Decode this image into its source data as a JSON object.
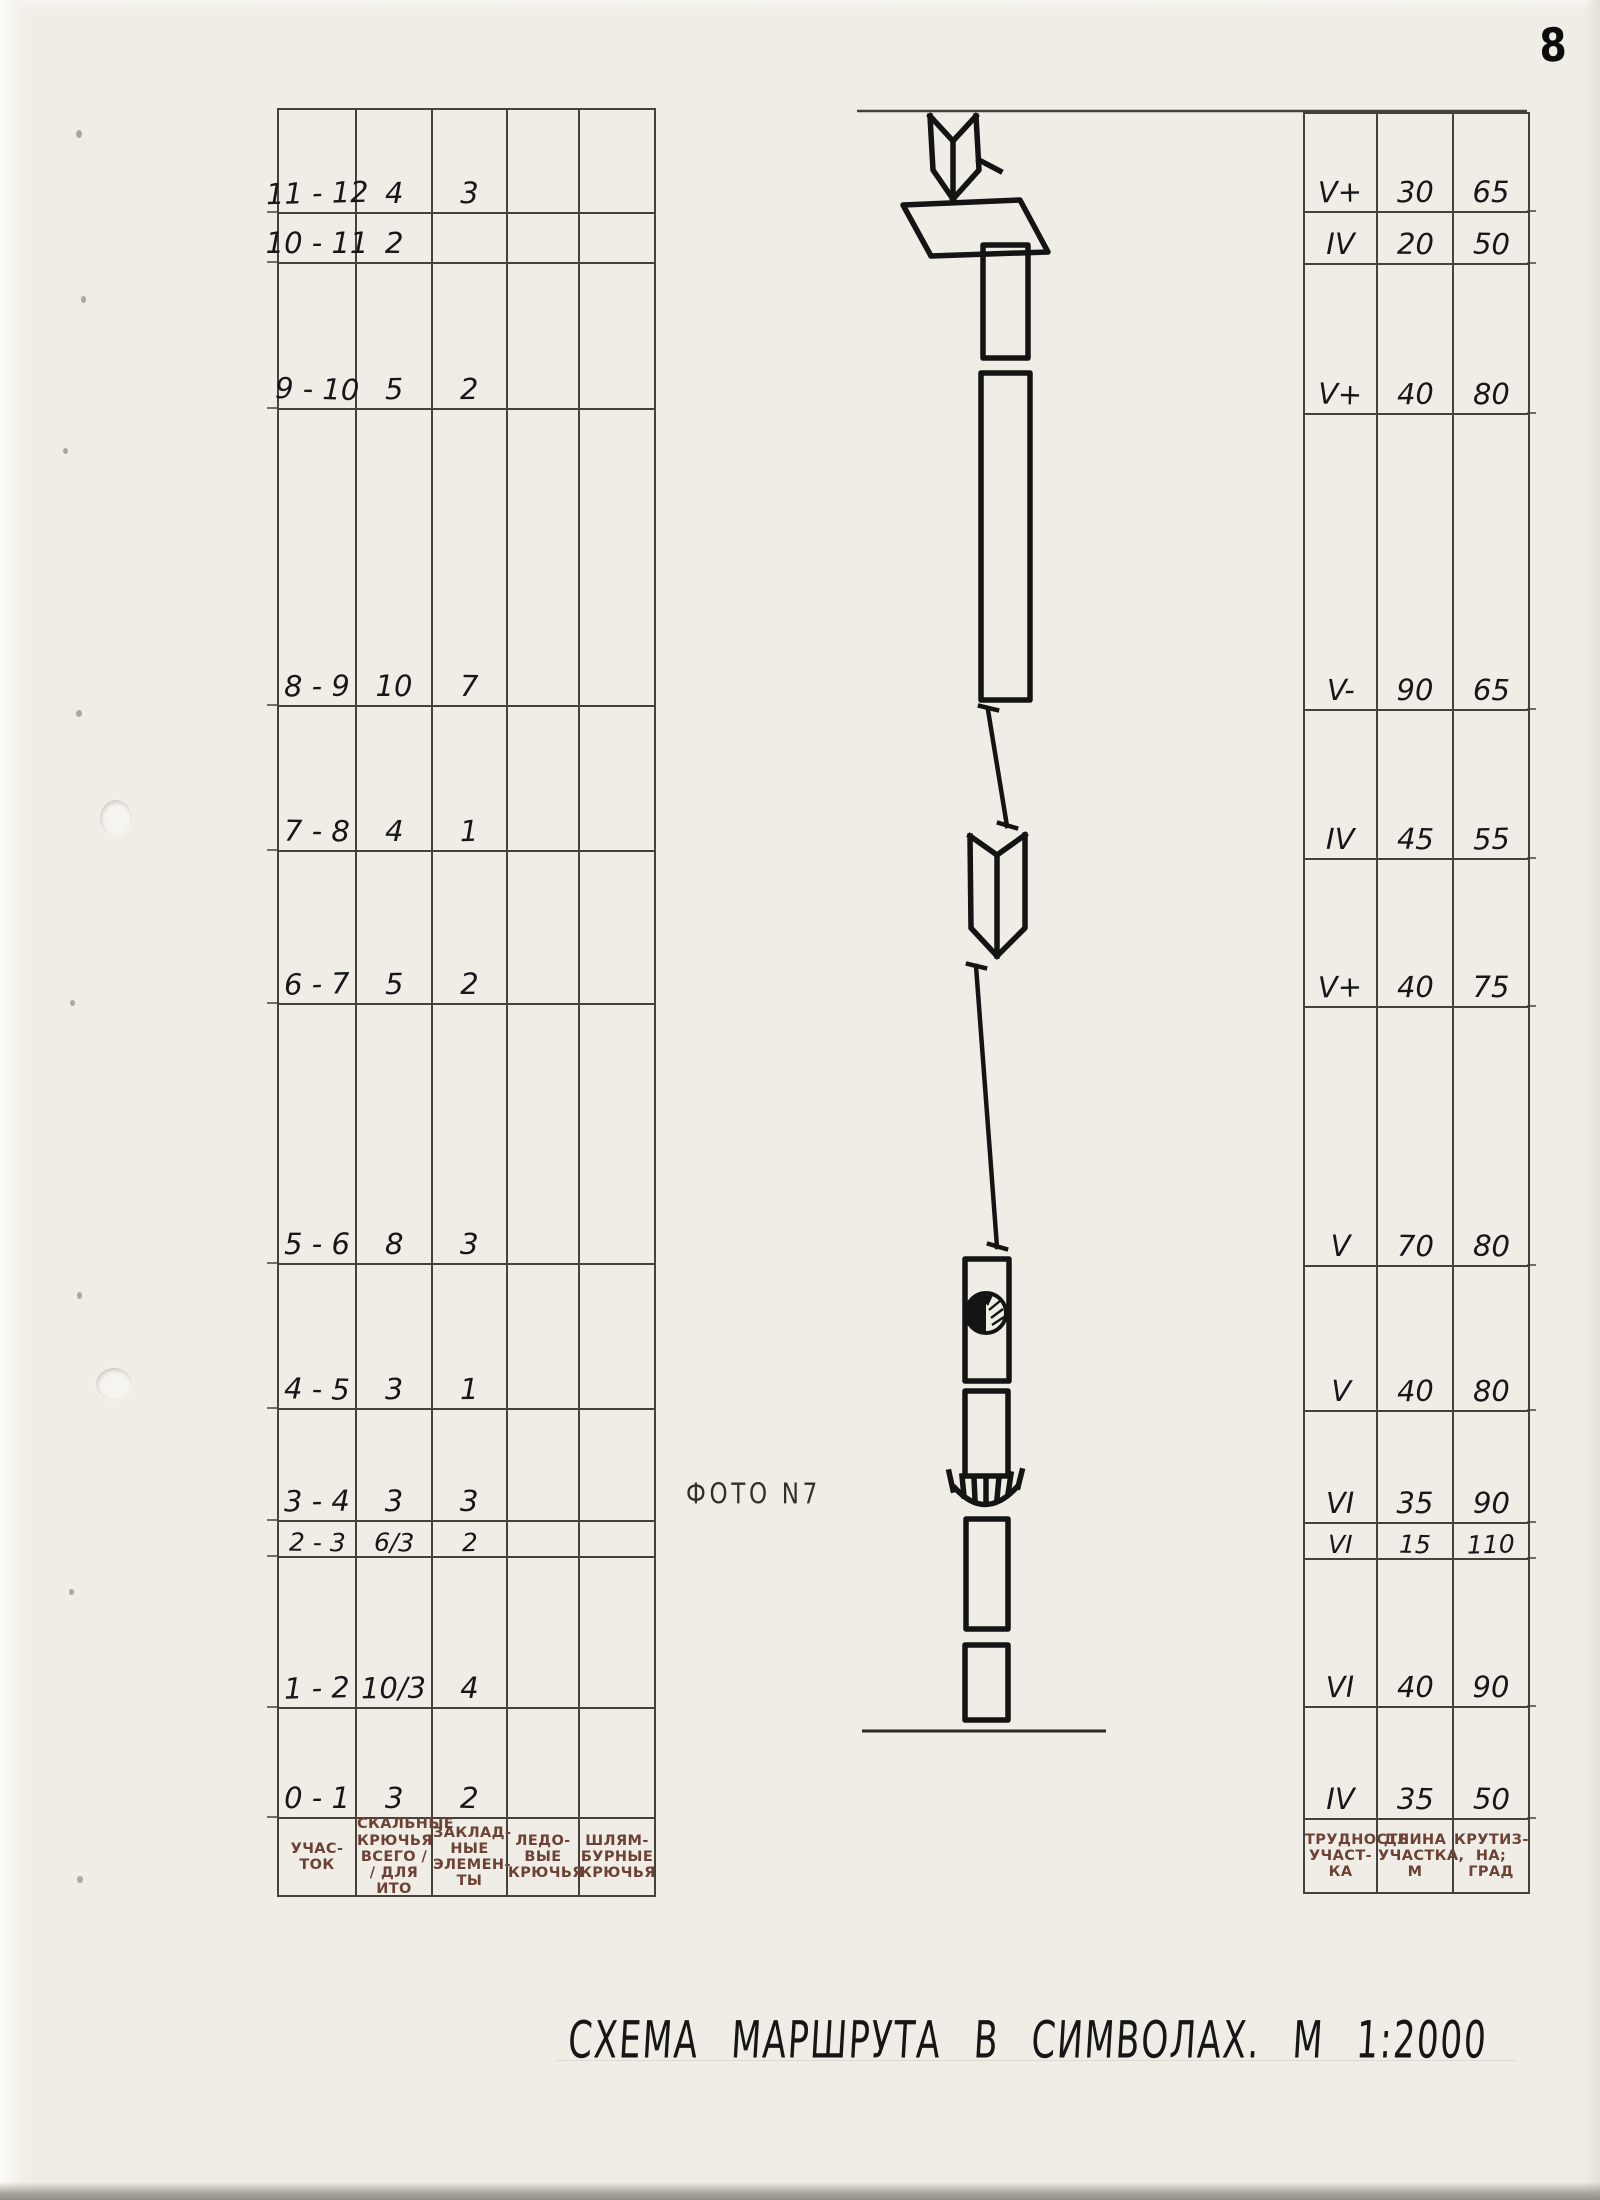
{
  "page": {
    "number": "8",
    "title": "СХЕМА МАРШРУТА В СИМВОЛАХ. М 1:2000",
    "photo_label": "ФОТО N7"
  },
  "equipment_table": {
    "column_headers": [
      "УЧАС-\nТОК",
      "СКАЛЬНЫЕ\nКРЮЧЬЯ\nВСЕГО ∕\n∕ ДЛЯ ИТО",
      "ЗАКЛАД-\nНЫЕ\nЭЛЕМЕН-\nТЫ",
      "ЛЕДО-\nВЫЕ\nКРЮЧЬЯ",
      "ШЛЯМ-\nБУРНЫЕ\nКРЮЧЬЯ"
    ],
    "rows": [
      [
        "11 - 12",
        "4",
        "3",
        "",
        ""
      ],
      [
        "10 - 11",
        "2",
        "",
        "",
        ""
      ],
      [
        "9 - 10",
        "5",
        "2",
        "",
        ""
      ],
      [
        "8 - 9",
        "10",
        "7",
        "",
        ""
      ],
      [
        "7 - 8",
        "4",
        "1",
        "",
        ""
      ],
      [
        "6 - 7",
        "5",
        "2",
        "",
        ""
      ],
      [
        "5 - 6",
        "8",
        "3",
        "",
        ""
      ],
      [
        "4 - 5",
        "3",
        "1",
        "",
        ""
      ],
      [
        "3 - 4",
        "3",
        "3",
        "",
        ""
      ],
      [
        "2 - 3",
        "6/3",
        "2",
        "",
        ""
      ],
      [
        "1 - 2",
        "10/3",
        "4",
        "",
        ""
      ],
      [
        "0 - 1",
        "3",
        "2",
        "",
        ""
      ]
    ]
  },
  "difficulty_table": {
    "column_headers": [
      "ТРУДНОСТЬ\nУЧАСТ-\nКА",
      "ДЛИНА\nУЧАСТКА,\nМ",
      "КРУТИЗ-\nНА;\nГРАД"
    ],
    "rows": [
      [
        "V+",
        "30",
        "65"
      ],
      [
        "IV",
        "20",
        "50"
      ],
      [
        "V+",
        "40",
        "80"
      ],
      [
        "V-",
        "90",
        "65"
      ],
      [
        "IV",
        "45",
        "55"
      ],
      [
        "V+",
        "40",
        "75"
      ],
      [
        "V",
        "70",
        "80"
      ],
      [
        "V",
        "40",
        "80"
      ],
      [
        "VI",
        "35",
        "90"
      ],
      [
        "VI",
        "15",
        "110"
      ],
      [
        "VI",
        "40",
        "90"
      ],
      [
        "IV",
        "35",
        "50"
      ]
    ]
  },
  "route_symbols": [
    "descent-arrow-corner",
    "ledge-parallelogram",
    "wall-segment",
    "wall-segment",
    "traverse-line",
    "inner-corner-dihedral",
    "traverse-line",
    "wall-segment",
    "grotto-mark",
    "wall-segment",
    "overhang-cornice",
    "wall-segment",
    "wall-segment",
    "route-base-line"
  ],
  "colors": {
    "paper": "#efede6",
    "ink": "#141414",
    "table_line": "#45413b",
    "header_ink": "#6d4236"
  }
}
